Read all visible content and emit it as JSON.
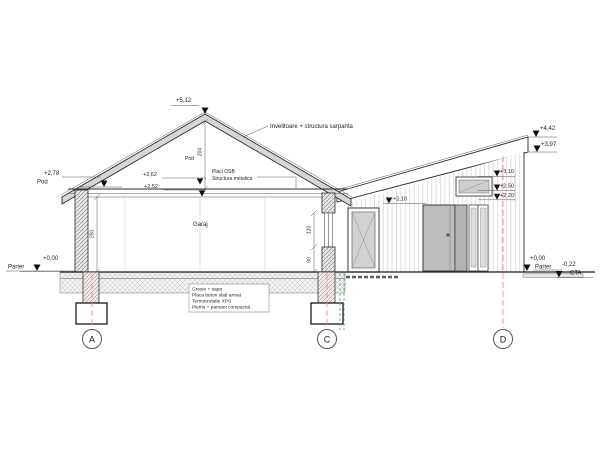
{
  "drawing": {
    "levels": {
      "ridge": "+5,12",
      "pod": "+2,78",
      "pod_label": "Pod",
      "plate_upper": "+2,62",
      "plate_lower": "+2,52",
      "parter_left": "+0,00",
      "parter_left_label": "Parter",
      "fascia_top": "+4,42",
      "fascia_bottom": "+3,97",
      "clerestory_top": "+3,10",
      "clerestory_sill": "+2,50",
      "lintel": "+2,20",
      "door_head": "+2,10",
      "parter_right": "+0,00",
      "parter_right_label": "Parter",
      "cta": "-0,22",
      "cta_label": "CTA"
    },
    "annotations": {
      "roof_note": "Invelitoare + structura sarpanta",
      "osb_note": "Placi OSB",
      "metal_note": "Structura metalica",
      "attic_label": "Pod",
      "room_label": "Garaj",
      "floor_notes": [
        "Gresie + sapa",
        "Placa beton slab armat",
        "Termoizolatie XPS",
        "Pietris + pamant compactat"
      ]
    },
    "dimensions": {
      "attic_height": "204",
      "room_height": "250",
      "window_height": "120",
      "parapet_height": "90"
    },
    "grid_axes": [
      "A",
      "C",
      "D"
    ]
  }
}
